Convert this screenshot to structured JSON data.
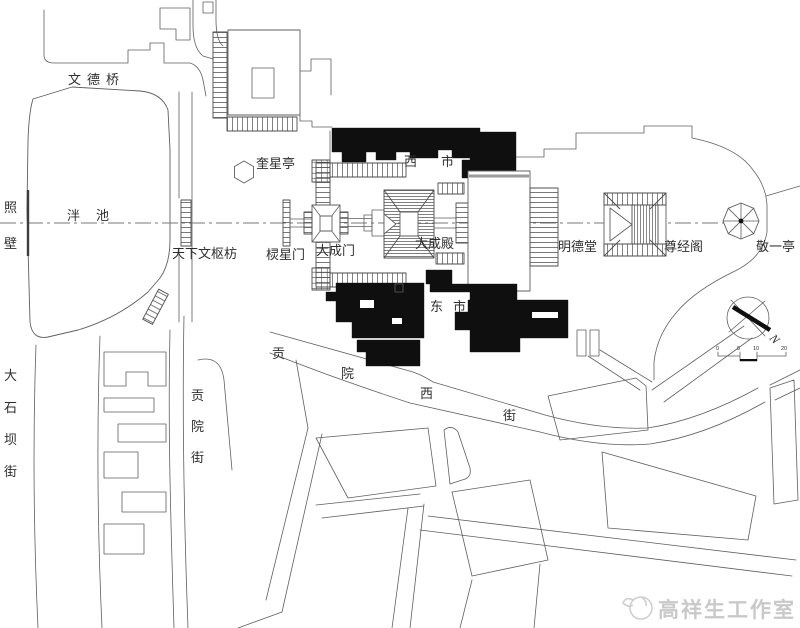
{
  "meta": {
    "drawing_type": "site plan"
  },
  "colors": {
    "background": "#ffffff",
    "line": "#5f5f5f",
    "solid_building_fill": "#0f0f0f",
    "label_text": "#2e2e2e",
    "watermark_gray": "#c9c9c9"
  },
  "labels": {
    "wende_bridge": "文德桥",
    "zhao_bi": "照壁",
    "pan_chi": "泮池",
    "tianxia_wenshu_fang": "天下文枢枋",
    "kuixing_ting": "奎星亭",
    "lingxing_men": "棂星门",
    "dacheng_men": "大成门",
    "dacheng_dian": "大成殿",
    "xi_shi": "西市",
    "dong_shi": "东市",
    "mingde_tang": "明德堂",
    "zunjing_ge": "尊经阁",
    "jingyi_ting": "敬一亭",
    "gongyuan_jie": "贡院街",
    "dashiba_jie": "大石坝街",
    "gongyuan_xi_jie": [
      "贡",
      "院",
      "西",
      "街"
    ]
  },
  "compass": {
    "north_label": "N"
  },
  "scale_bar": {
    "tick_labels": [
      "0",
      "5",
      "10",
      "20"
    ]
  },
  "watermark": {
    "studio_name": "高祥生工作室"
  }
}
